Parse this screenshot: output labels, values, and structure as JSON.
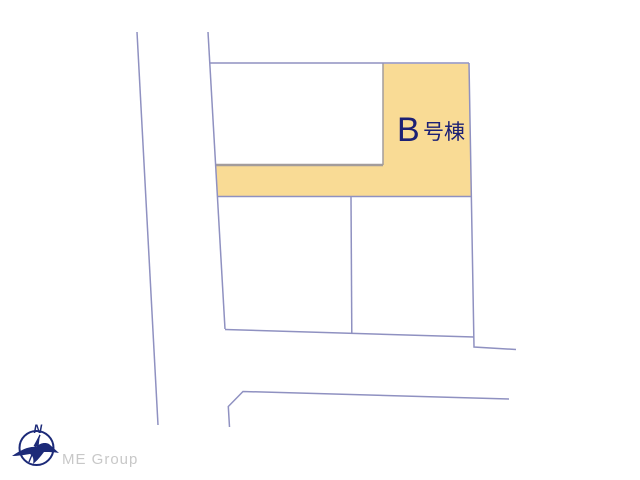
{
  "plan": {
    "lot_b": {
      "label": "B号棟",
      "prefix": "B",
      "suffix": "号棟"
    },
    "colors": {
      "lot_fill": "#f9db95",
      "boundary": "#8f91c1",
      "inner_line": "#a39c9b",
      "label_text": "#1c2074"
    }
  },
  "compass": {
    "north_label": "N",
    "color": "#1c2a78"
  },
  "branding": {
    "logo_text": "ME Group",
    "color": "#c8c8c8"
  }
}
